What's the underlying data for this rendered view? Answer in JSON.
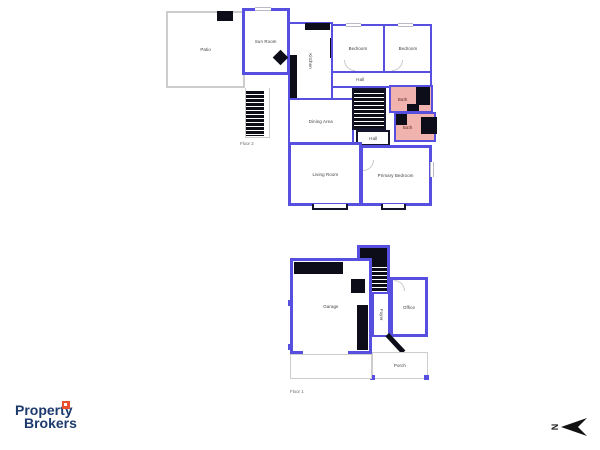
{
  "brand": {
    "line1": "Property",
    "line2": "Brokers"
  },
  "compass": {
    "letter": "N"
  },
  "floor2": {
    "label": "Floor 2",
    "rooms": {
      "patio": "Patio",
      "sun_room": "Sun Room",
      "kitchen": "Kitchen",
      "bedroom_left": "Bedroom",
      "bedroom_right": "Bedroom",
      "hall_upper": "Hall",
      "bath_upper": "Bath",
      "bath_lower": "Bath",
      "dining": "Dining Area",
      "hall_lower": "Hall",
      "living": "Living Room",
      "primary_bedroom": "Primary Bedroom"
    }
  },
  "floor1": {
    "label": "Floor 1",
    "rooms": {
      "garage": "Garage",
      "foyer": "Foyer",
      "office": "Office",
      "porch": "Porch"
    }
  },
  "colors": {
    "wall": "#564fe0",
    "bath_fill": "#f1b3ae",
    "patio_outline": "#cdcdcd",
    "fixture_black": "#0d0d1a",
    "brand_navy": "#1d3a6d",
    "brand_orange": "#e8502e"
  }
}
